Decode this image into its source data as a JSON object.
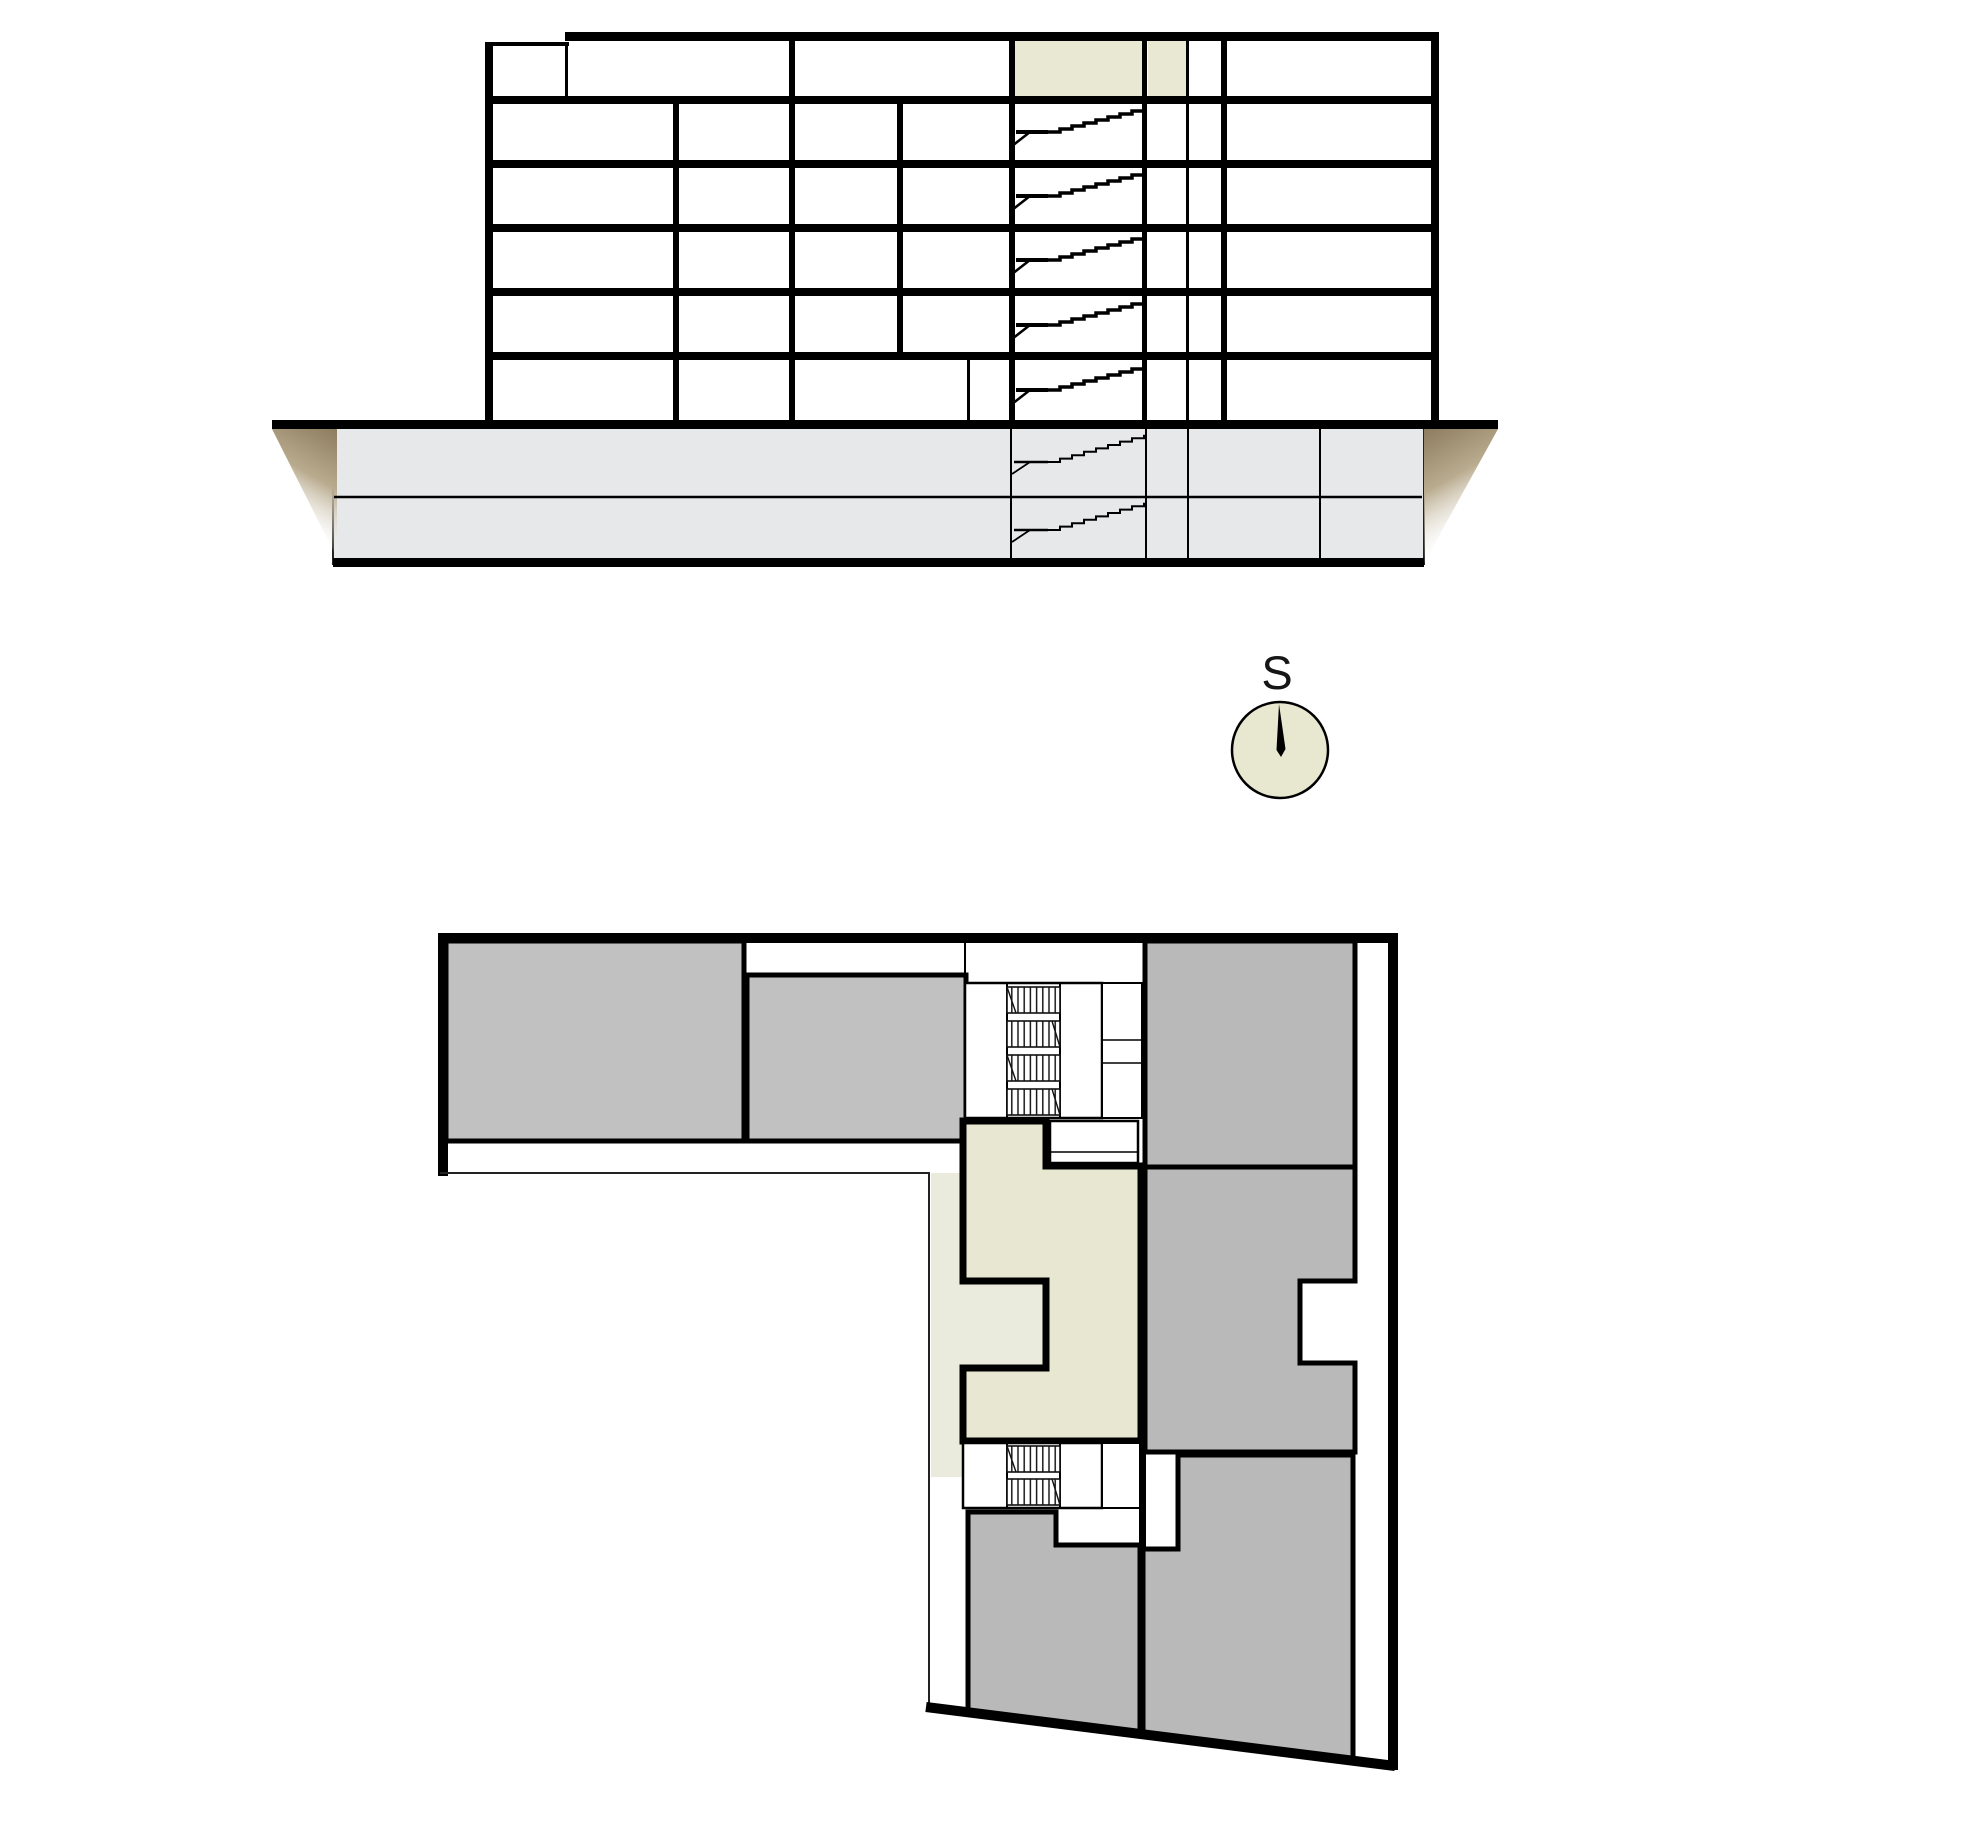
{
  "compass": {
    "label": "S"
  },
  "palette": {
    "line": "#000000",
    "compass_fill": "#e8e8d0",
    "section_highlight": "#e9e8d2",
    "plan_apartment": "#e8e7d1",
    "plan_underlay": "#ebebdd",
    "gray_top": "#c1c1c1",
    "gray_right": "#b9b9b9",
    "basement_fill": "#e7e8ea",
    "background": "#ffffff"
  },
  "section": {
    "floors_above_ground": 6,
    "basement_levels": 2,
    "highlighted_cells": 2
  },
  "plan": {
    "gray_rooms": 6,
    "highlighted_units": 1,
    "stairwells": 2
  }
}
